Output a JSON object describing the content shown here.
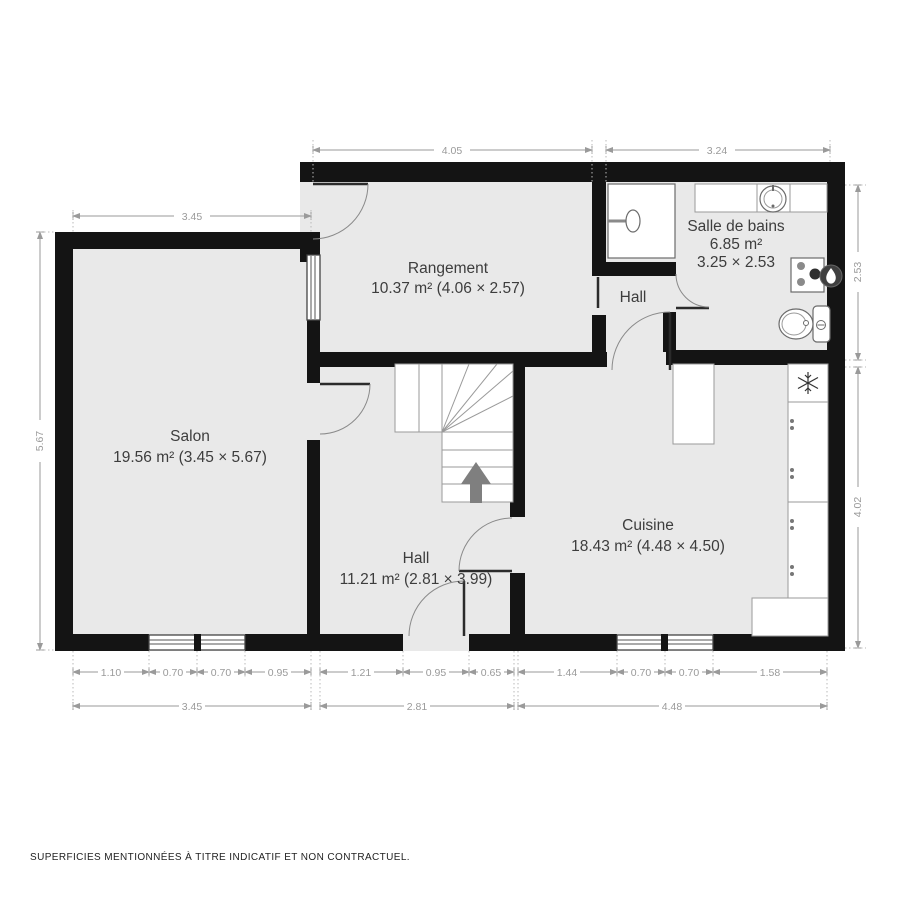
{
  "document": {
    "type": "floor-plan",
    "footer_disclaimer": "SUPERFICIES MENTIONNÉES À TITRE INDICATIF ET NON CONTRACTUEL."
  },
  "rooms": {
    "rangement": {
      "name": "Rangement",
      "details": "10.37 m² (4.06 × 2.57)"
    },
    "salle_de_bains": {
      "name": "Salle de bains",
      "area": "6.85 m²",
      "size": "3.25 × 2.53"
    },
    "hall_top": {
      "name": "Hall"
    },
    "salon": {
      "name": "Salon",
      "details": "19.56 m² (3.45 × 5.67)"
    },
    "hall": {
      "name": "Hall",
      "details": "11.21 m² (2.81 × 3.99)"
    },
    "cuisine": {
      "name": "Cuisine",
      "details": "18.43 m² (4.48 × 4.50)"
    }
  },
  "dims": {
    "top_left": "4.05",
    "top_right": "3.24",
    "salon_top": "3.45",
    "salon_left": "5.67",
    "bath_right": "2.53",
    "cuisine_right": "4.02",
    "row1": [
      "1.10",
      "0.70",
      "0.70",
      "0.95",
      "1.21",
      "0.95",
      "0.65",
      "1.44",
      "0.70",
      "0.70",
      "1.58"
    ],
    "row2": [
      "3.45",
      "2.81",
      "4.48"
    ]
  },
  "icons": {
    "stairs_direction": "up-arrow",
    "water_heater": "flame",
    "fridge": "snowflake",
    "shower": "shower-head",
    "washbasin": "round-sink",
    "toilet": "wc"
  },
  "colors": {
    "wall": "#141414",
    "floor": "#e9e9e9",
    "dimension": "#9a9a9a",
    "room_label": "#3d3d3d",
    "stair_arrow": "#7f7f7f",
    "heater_badge": "#3f3f3f"
  }
}
